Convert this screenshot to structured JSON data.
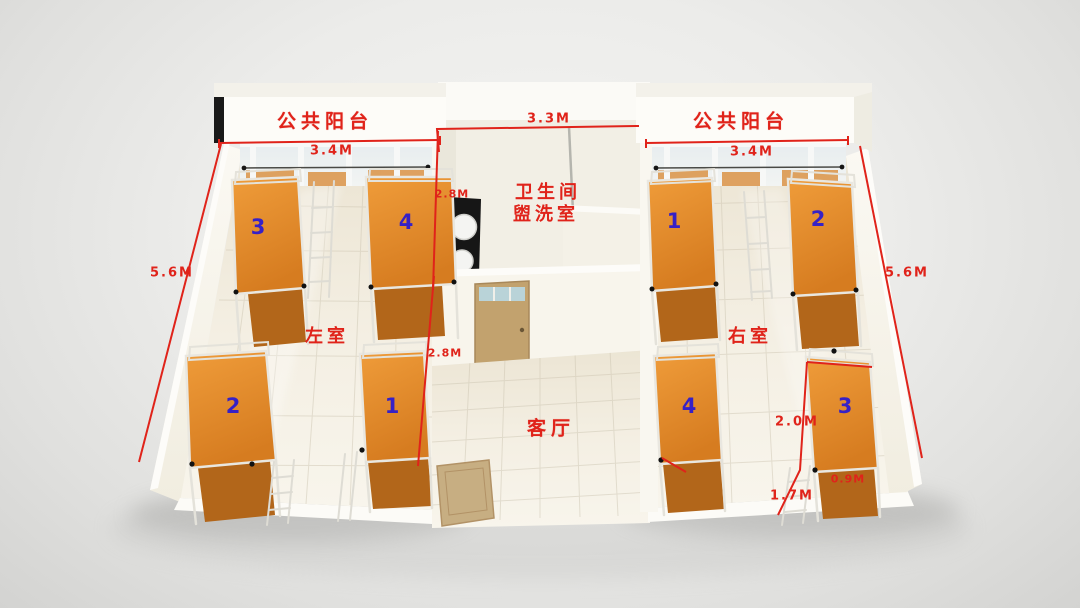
{
  "scene": {
    "balcony_left": {
      "label": "公共阳台",
      "width": "3.4M"
    },
    "balcony_right": {
      "label": "公共阳台",
      "width": "3.4M"
    },
    "bathroom": {
      "label_line1": "卫生间",
      "label_line2": "盥洗室",
      "width": "3.3M",
      "depth": "2.8M"
    },
    "living_room": {
      "label": "客厅",
      "depth": "2.8M"
    },
    "left_room": {
      "label": "左室",
      "depth": "5.6M",
      "beds": [
        "3",
        "4",
        "2",
        "1"
      ]
    },
    "right_room": {
      "label": "右室",
      "depth": "5.6M",
      "beds": [
        "1",
        "2",
        "4",
        "3"
      ]
    },
    "bed_dimensions": {
      "length": "2.0M",
      "aisle": "1.7M",
      "width": "0.9M"
    },
    "colors": {
      "dimension_red": "#e0231a",
      "bed_number_blue": "#3621c6",
      "bed_orange": "#e08a2e",
      "bed_orange_dark": "#b2661a",
      "wall_cream": "#f6f3ea",
      "floor_cream": "#efe9da",
      "background_gray": "#ececea",
      "door_tan": "#c2a26e",
      "sink_counter_black": "#161616"
    }
  }
}
